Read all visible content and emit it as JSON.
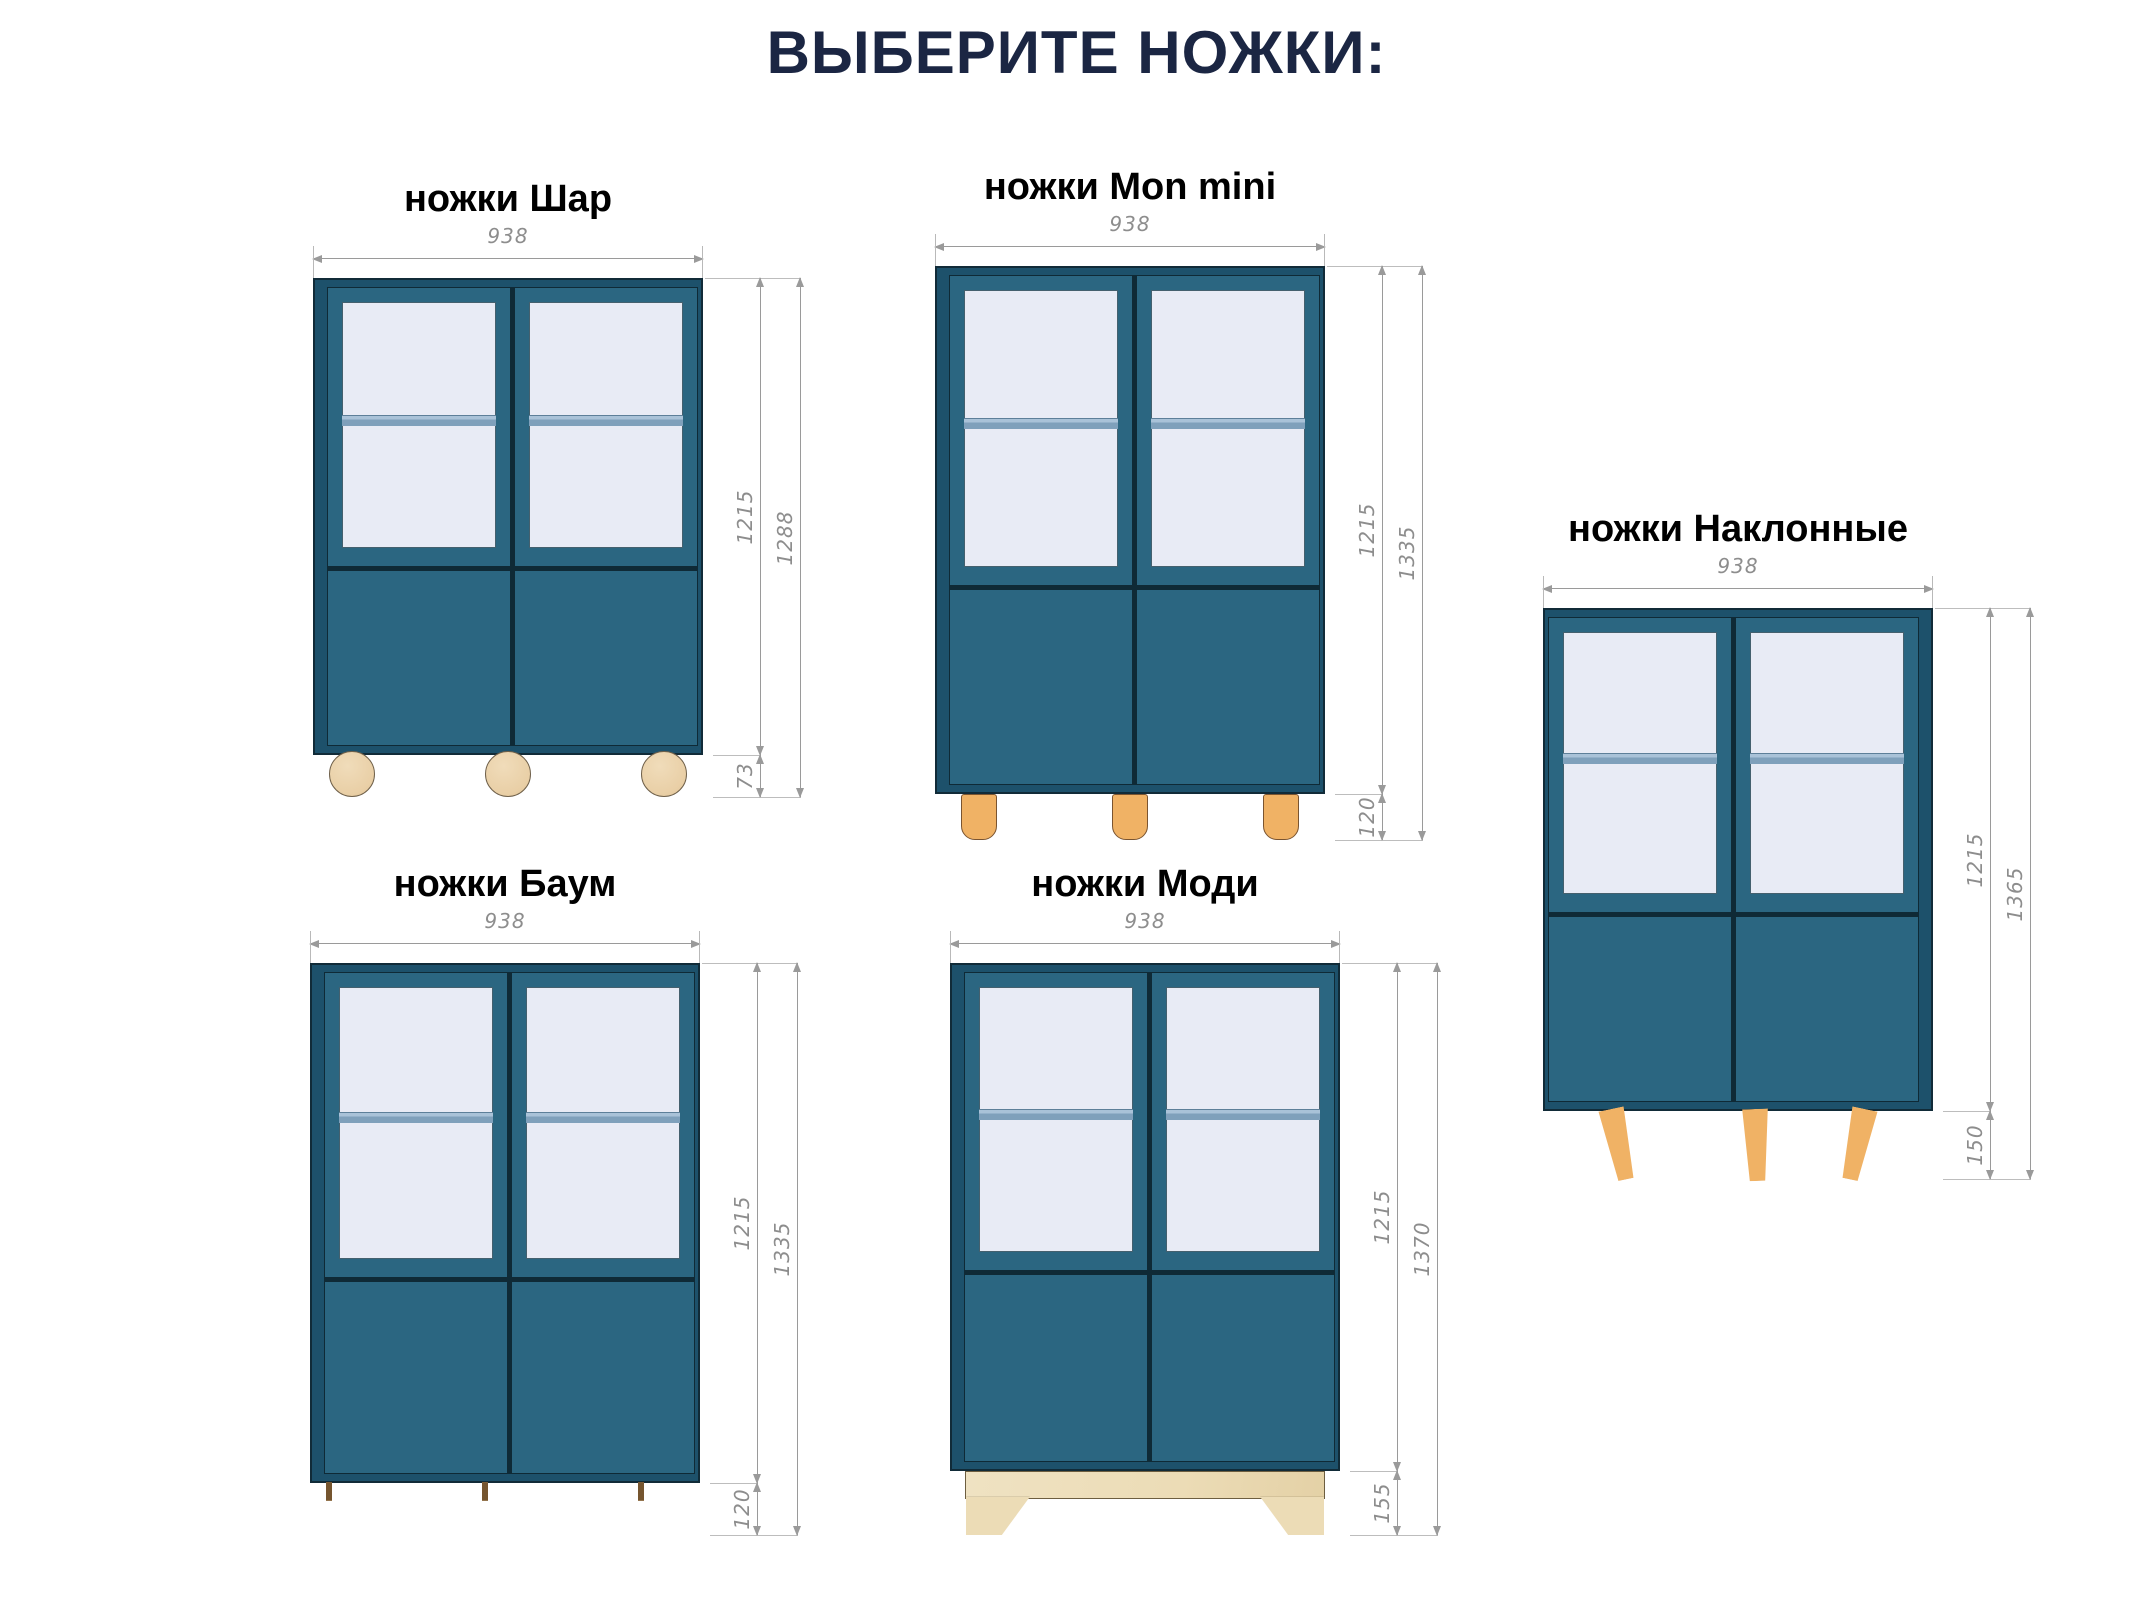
{
  "title": "ВЫБЕРИТЕ НОЖКИ:",
  "cabinets": [
    {
      "name": "Шар",
      "label": "ножки Шар",
      "width_mm": "938",
      "body_height_mm": "1215",
      "total_height_mm": "1288",
      "leg_height_mm": "73",
      "leg_style": "ball-feet",
      "legs_visible": 3
    },
    {
      "name": "Mon mini",
      "label": "ножки Mon mini",
      "width_mm": "938",
      "body_height_mm": "1215",
      "total_height_mm": "1335",
      "leg_height_mm": "120",
      "leg_style": "cylinder-feet",
      "legs_visible": 3
    },
    {
      "name": "Наклонные",
      "label": "ножки Наклонные",
      "width_mm": "938",
      "body_height_mm": "1215",
      "total_height_mm": "1365",
      "leg_height_mm": "150",
      "leg_style": "angled-tapered-legs",
      "legs_visible": 3
    },
    {
      "name": "Баум",
      "label": "ножки Баум",
      "width_mm": "938",
      "body_height_mm": "1215",
      "total_height_mm": "1335",
      "leg_height_mm": "120",
      "leg_style": "stacked-disc-feet",
      "legs_visible": 3
    },
    {
      "name": "Моди",
      "label": "ножки Моди",
      "width_mm": "938",
      "body_height_mm": "1215",
      "total_height_mm": "1370",
      "leg_height_mm": "155",
      "leg_style": "plinth-base",
      "legs_visible": 1
    }
  ],
  "colors": {
    "title": "#1b2643",
    "label": "#000000",
    "cabinet-teal": "#2b6681",
    "cabinet-edge": "#1d516b",
    "outline": "#112b38",
    "glass": "#e8ebf5",
    "shelf": "#7fa0bb",
    "shelf-light": "#a9c2d8",
    "wood": "#f0b265",
    "wood-light": "#ecdcb6",
    "ball": "#e9cfa6",
    "dim-line": "#9a9a9a",
    "dim-text": "#8d8d8d"
  }
}
